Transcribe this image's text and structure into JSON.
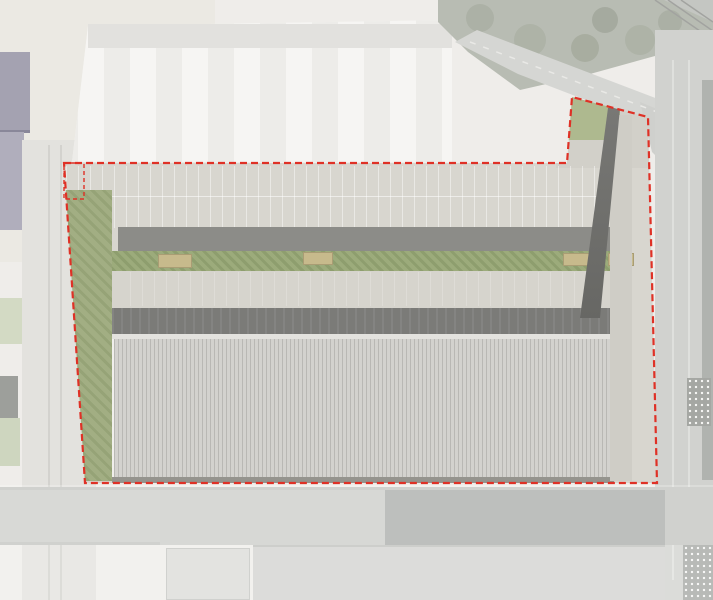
{
  "plan": {
    "labels": {
      "ground_floor": "RDC",
      "first_floor": "R+1"
    },
    "boundary": {
      "color": "#df3126",
      "style": "dashed"
    },
    "roof": {
      "bays": 7,
      "solar_rows_top": 4,
      "solar_rows_bottom": 4,
      "skylight_rows": 2,
      "skylight_cols": 3
    },
    "colors": {
      "aerial_base": "#ebe9e5",
      "concrete": "#d7d5ce",
      "driveway_dark": "#8c8c88",
      "loading_band": "#7b7b78",
      "green_strip": "#9cab7b",
      "roof_base": "#d3d2ce",
      "solar_panel": "#8d96b4",
      "skylight_glass": "#454c66",
      "tree_green": "#a8bc78"
    }
  }
}
